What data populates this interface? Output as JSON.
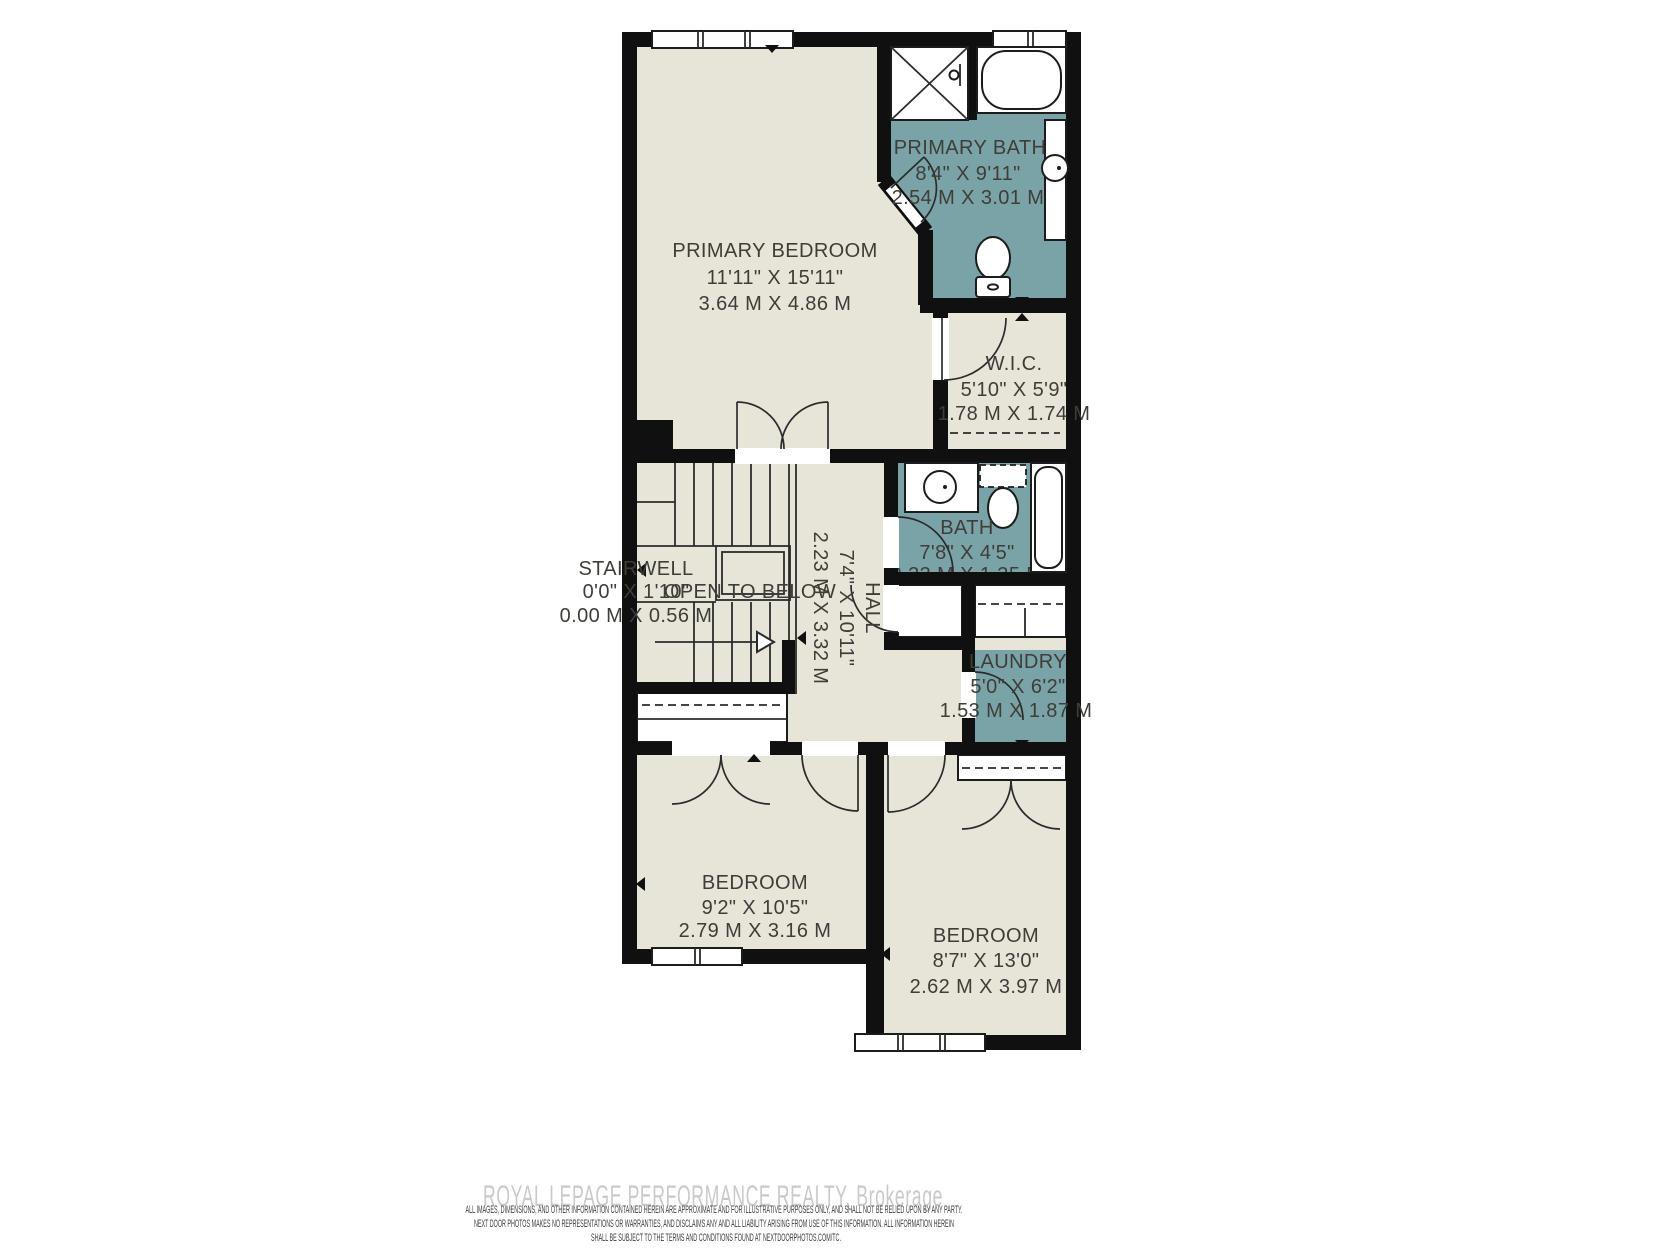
{
  "colors": {
    "background": "#ffffff",
    "wall": "#101010",
    "room_fill": "#e7e4d8",
    "wet_room_fill": "#7aa3a8",
    "label_text": "#3f3d38",
    "watermark_text": "#c9c9c9",
    "disclaimer_text": "#3d3d3d"
  },
  "rooms": {
    "primary_bedroom": {
      "name": "PRIMARY BEDROOM",
      "imperial": "11'11\" X 15'11\"",
      "metric": "3.64 M X 4.86 M"
    },
    "primary_bath": {
      "name": "PRIMARY BATH",
      "imperial": "8'4\" X 9'11\"",
      "metric": "2.54 M X 3.01 M"
    },
    "walk_in_closet": {
      "name": "W.I.C.",
      "imperial": "5'10\" X 5'9\"",
      "metric": "1.78 M X 1.74 M"
    },
    "stairwell": {
      "name": "STAIRWELL",
      "imperial": "0'0\" X 1'10\"",
      "metric": "0.00 M X 0.56 M"
    },
    "open_to_below": {
      "name": "OPEN TO BELOW"
    },
    "hall": {
      "name": "HALL",
      "imperial": "7'4\" X 10'11\"",
      "metric": "2.23 M X 3.32 M"
    },
    "bath": {
      "name": "BATH",
      "imperial": "7'8\" X 4'5\"",
      "metric": "2.33 M X 1.35 M"
    },
    "laundry": {
      "name": "LAUNDRY",
      "imperial": "5'0\" X 6'2\"",
      "metric": "1.53 M X 1.87 M"
    },
    "bedroom_left": {
      "name": "BEDROOM",
      "imperial": "9'2\" X 10'5\"",
      "metric": "2.79 M X 3.16 M"
    },
    "bedroom_right": {
      "name": "BEDROOM",
      "imperial": "8'7\" X 13'0\"",
      "metric": "2.62 M X 3.97 M"
    }
  },
  "footer": {
    "watermark": "ROYAL LEPAGE PERFORMANCE REALTY, Brokerage",
    "disclaimer_line1": "ALL IMAGES, DIMENSIONS, AND OTHER INFORMATION CONTAINED HEREIN ARE APPROXIMATE AND FOR ILLUSTRATIVE PURPOSES ONLY, AND SHALL NOT BE RELIED UPON BY ANY PARTY.",
    "disclaimer_line2": "NEXT DOOR PHOTOS MAKES NO REPRESENTATIONS OR WARRANTIES, AND DISCLAIMS ANY AND ALL LIABILITY ARISING FROM USE OF THIS INFORMATION. ALL INFORMATION HEREIN",
    "disclaimer_line3": "SHALL BE SUBJECT TO THE TERMS AND CONDITIONS FOUND AT NEXTDOORPHOTOS.COM/TC."
  }
}
